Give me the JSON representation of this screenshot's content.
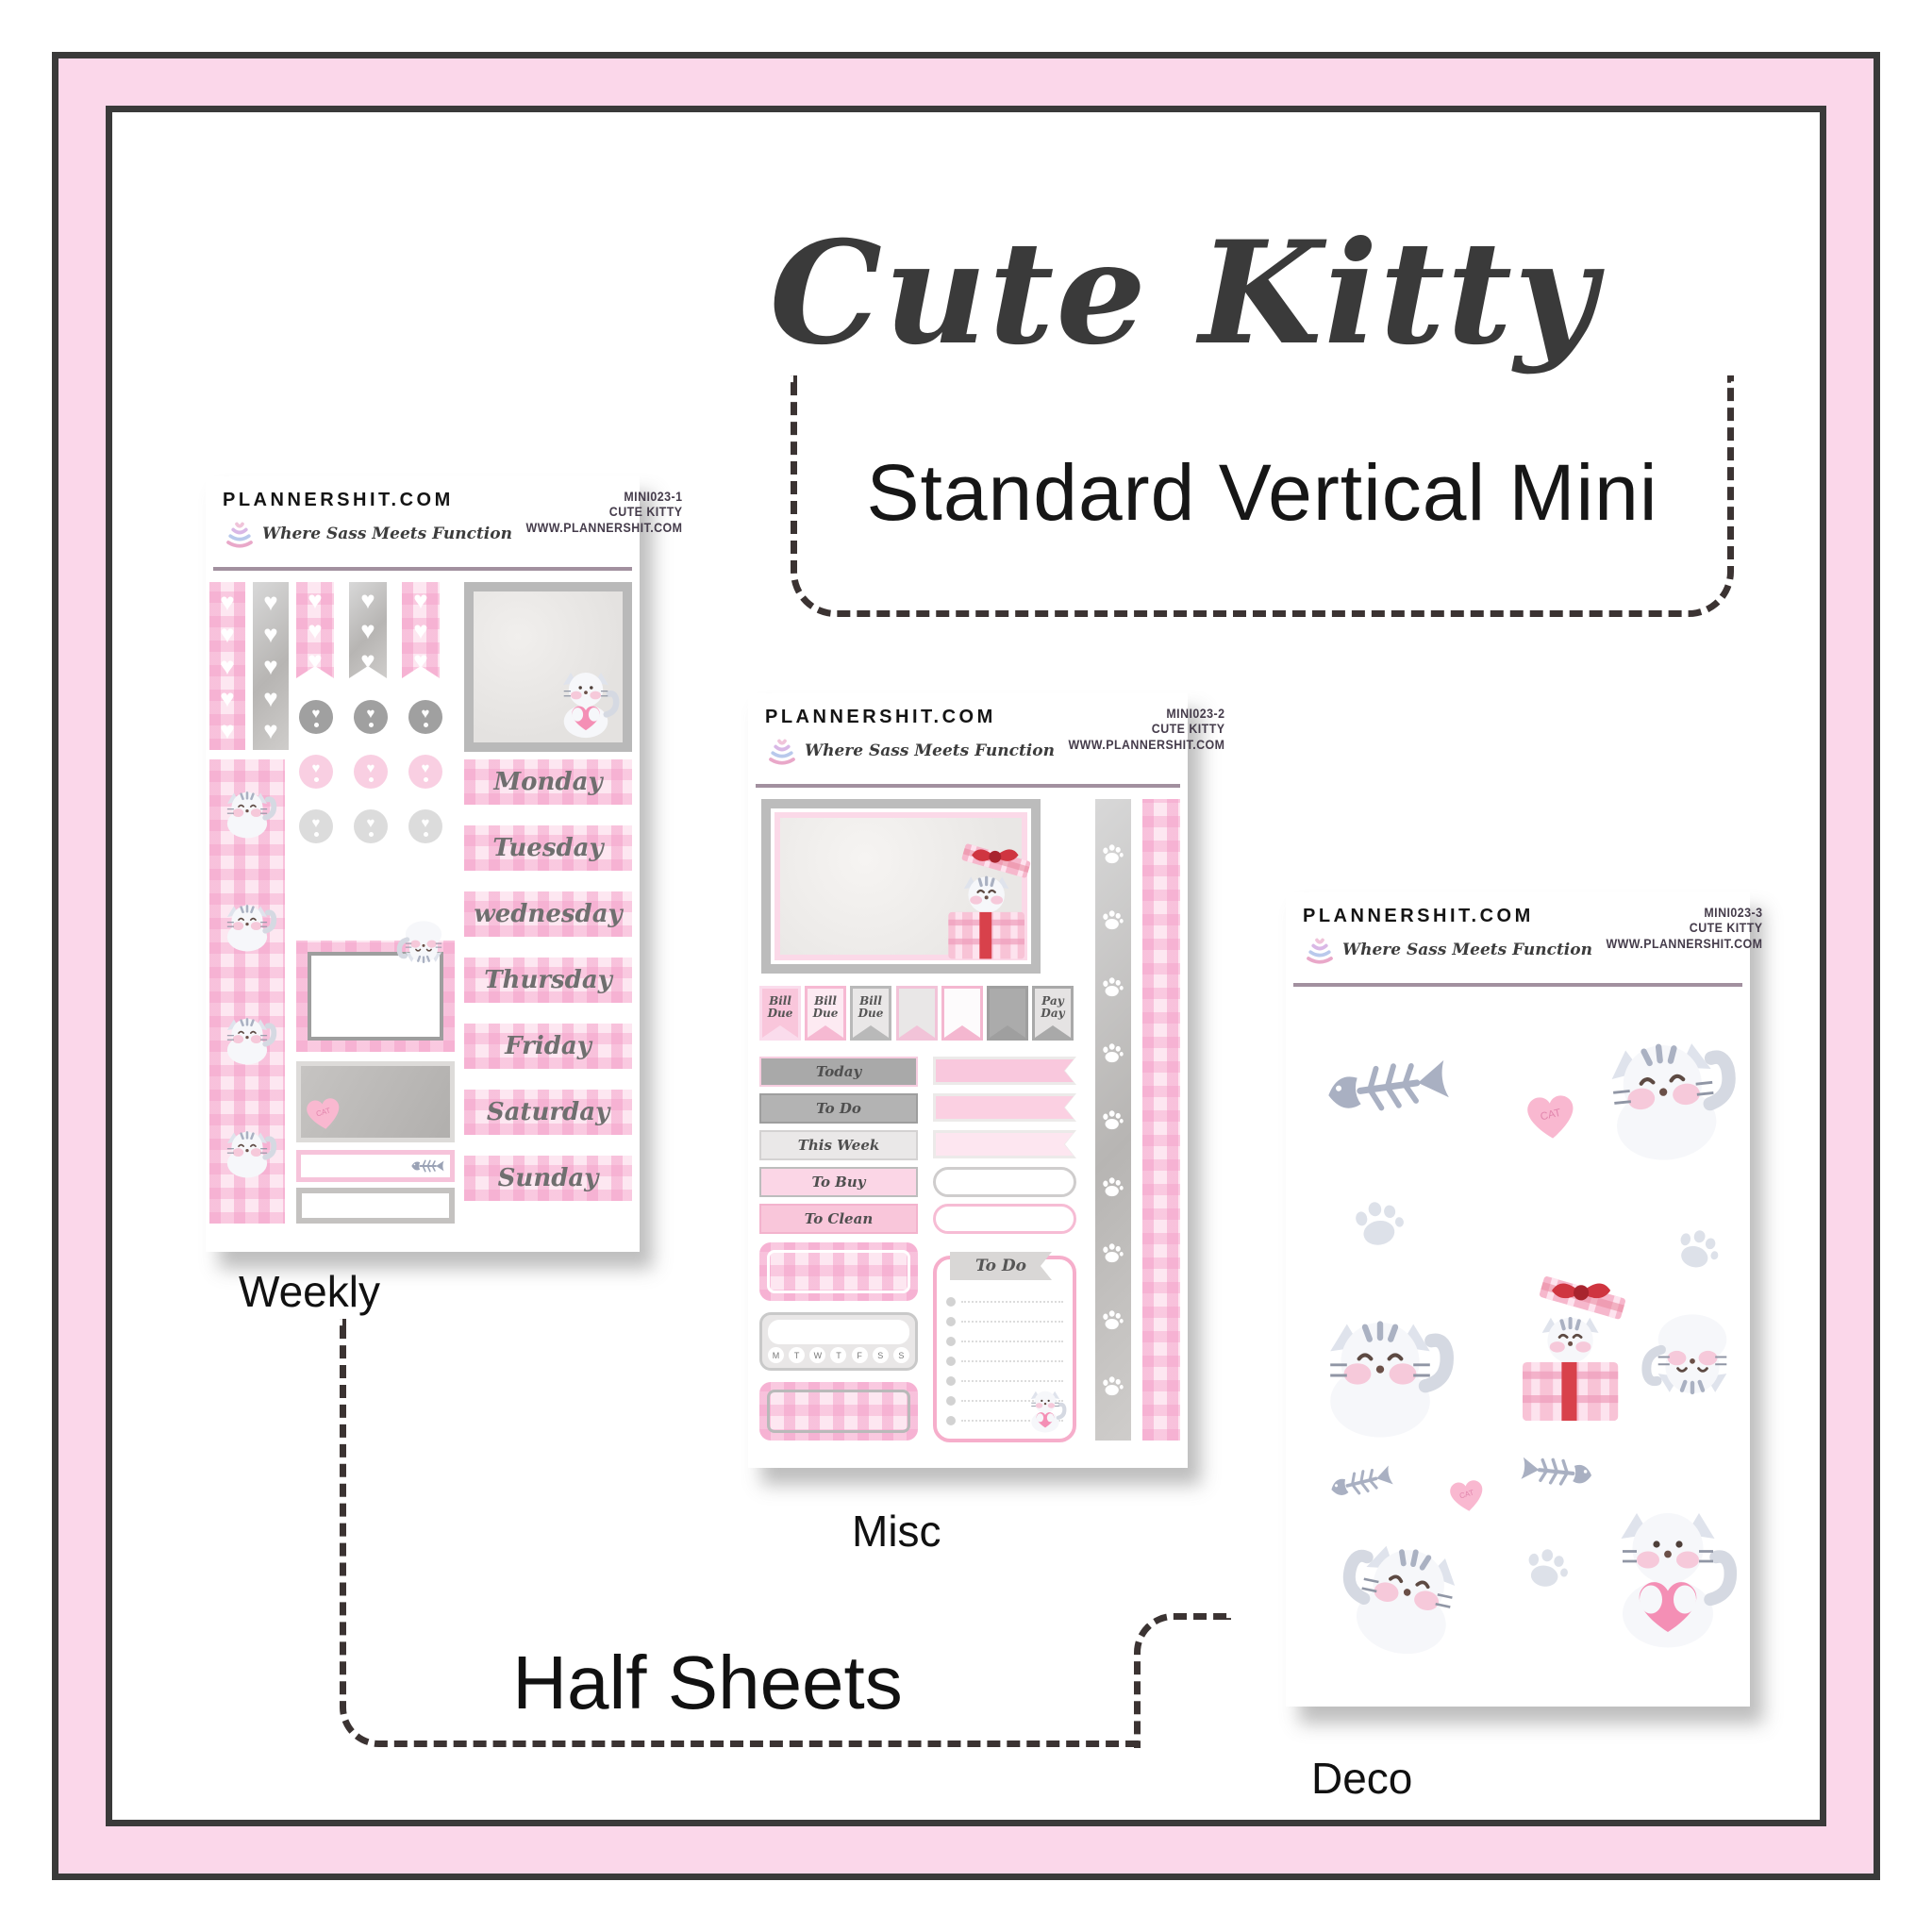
{
  "page": {
    "title": "Cute Kitty",
    "subtitle": "Standard Vertical Mini",
    "group_label": "Half Sheets"
  },
  "branding": {
    "site": "PLANNERSHIT.COM",
    "tagline": "Where Sass Meets Function",
    "url": "WWW.PLANNERSHIT.COM",
    "product": "Cute Kitty"
  },
  "sheets": [
    {
      "code": "MINI023-1",
      "label": "Weekly",
      "days": [
        "Monday",
        "Tuesday",
        "wednesday",
        "Thursday",
        "Friday",
        "Saturday",
        "Sunday"
      ]
    },
    {
      "code": "MINI023-2",
      "label": "Misc",
      "flags": [
        "Bill Due",
        "Bill Due",
        "Bill Due",
        "",
        "",
        "",
        "Pay Day"
      ],
      "strips": [
        "Today",
        "To Do",
        "This Week",
        "To Buy",
        "To Clean"
      ],
      "todo_title": "To Do",
      "week": [
        "M",
        "T",
        "W",
        "T",
        "F",
        "S",
        "S"
      ]
    },
    {
      "code": "MINI023-3",
      "label": "Deco"
    }
  ],
  "stickers": {
    "candy_heart_text": "CAT"
  },
  "icons": {
    "heart": "♥"
  },
  "colors": {
    "frame_pink": "#fbd7ea",
    "frame_line": "#3a3a3a",
    "divider_mauve": "#a2909f",
    "pink": "#f9c6db",
    "gray": "#b9b9b9",
    "bow_red": "#cf3540",
    "dash": "#3b3332",
    "hand_text": "#6f6f6f"
  }
}
